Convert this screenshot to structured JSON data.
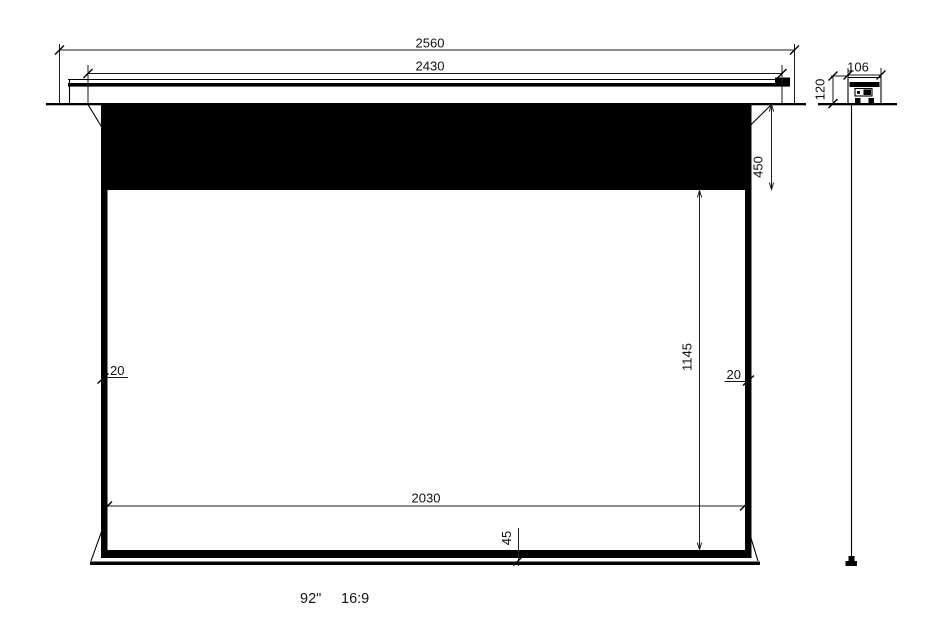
{
  "drawing": {
    "front_view": {
      "overall_width": "2560",
      "inner_width": "2430",
      "top_border_height": "450",
      "viewing_height": "1145",
      "left_border_width": "20",
      "right_border_width": "20",
      "viewing_width": "2030",
      "bottom_bar_height": "45"
    },
    "side_view": {
      "case_width": "106",
      "case_height": "120"
    },
    "caption": {
      "screen_size": "92\"",
      "aspect_ratio": "16:9"
    },
    "colors": {
      "line": "#000000",
      "background": "#ffffff"
    }
  }
}
